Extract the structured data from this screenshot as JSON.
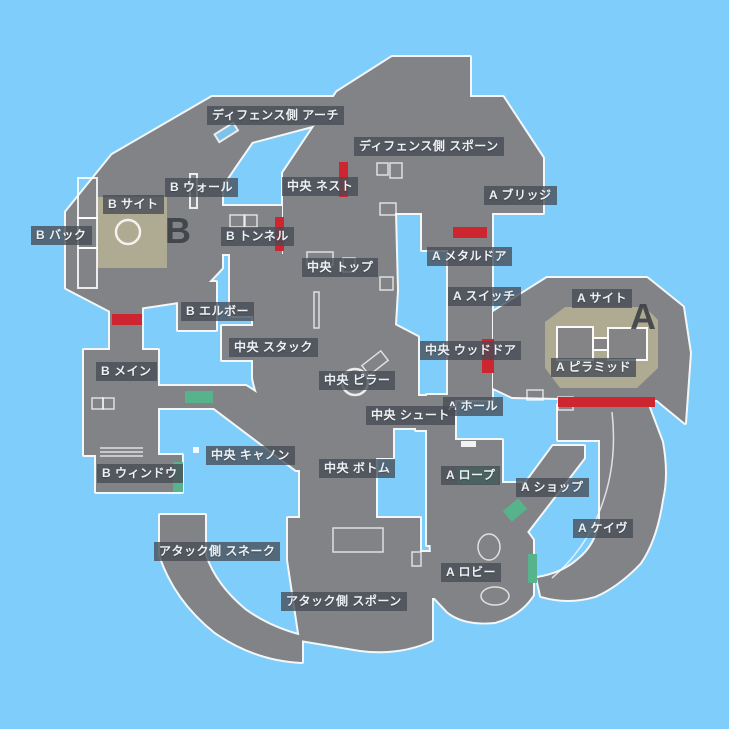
{
  "map": {
    "name": "split-minimap-japanese",
    "colors": {
      "bg": "#7ecdfa",
      "ground": "#828387",
      "outline": "#f4f7f8",
      "red": "#cd2630",
      "teal": "#57b38b",
      "site": "#b3ae92",
      "pill_bg": "rgba(70,75,84,0.78)",
      "pill_text": "#eef1f4",
      "letter": "#3a3f45"
    },
    "site_letters": [
      {
        "text": "B",
        "x": 165,
        "y": 214
      },
      {
        "text": "A",
        "x": 630,
        "y": 300
      }
    ],
    "labels": [
      {
        "text": "ディフェンス側 アーチ",
        "x": 207,
        "y": 106
      },
      {
        "text": "ディフェンス側 スポーン",
        "x": 354,
        "y": 137
      },
      {
        "text": "B ウォール",
        "x": 165,
        "y": 178
      },
      {
        "text": "中央 ネスト",
        "x": 282,
        "y": 177
      },
      {
        "text": "A ブリッジ",
        "x": 484,
        "y": 186
      },
      {
        "text": "B サイト",
        "x": 103,
        "y": 195
      },
      {
        "text": "B バック",
        "x": 31,
        "y": 226
      },
      {
        "text": "B トンネル",
        "x": 221,
        "y": 227
      },
      {
        "text": "A メタルドア",
        "x": 427,
        "y": 247
      },
      {
        "text": "中央 トップ",
        "x": 302,
        "y": 258
      },
      {
        "text": "A スイッチ",
        "x": 448,
        "y": 287
      },
      {
        "text": "A サイト",
        "x": 572,
        "y": 289
      },
      {
        "text": "B エルボー",
        "x": 181,
        "y": 302
      },
      {
        "text": "中央 スタック",
        "x": 229,
        "y": 338
      },
      {
        "text": "中央 ウッドドア",
        "x": 420,
        "y": 341
      },
      {
        "text": "A ピラミッド",
        "x": 551,
        "y": 358
      },
      {
        "text": "B メイン",
        "x": 96,
        "y": 362
      },
      {
        "text": "中央 ピラー",
        "x": 319,
        "y": 371
      },
      {
        "text": "A ホール",
        "x": 443,
        "y": 397
      },
      {
        "text": "中央 シュート",
        "x": 366,
        "y": 406
      },
      {
        "text": "中央 キャノン",
        "x": 206,
        "y": 446
      },
      {
        "text": "中央 ボトム",
        "x": 319,
        "y": 459
      },
      {
        "text": "A ロープ",
        "x": 441,
        "y": 466
      },
      {
        "text": "B ウィンドウ",
        "x": 97,
        "y": 464
      },
      {
        "text": "A ショップ",
        "x": 516,
        "y": 478
      },
      {
        "text": "A ケイヴ",
        "x": 573,
        "y": 519
      },
      {
        "text": "アタック側 スネーク",
        "x": 154,
        "y": 542
      },
      {
        "text": "A ロビー",
        "x": 441,
        "y": 563
      },
      {
        "text": "アタック側 スポーン",
        "x": 281,
        "y": 592
      }
    ]
  }
}
